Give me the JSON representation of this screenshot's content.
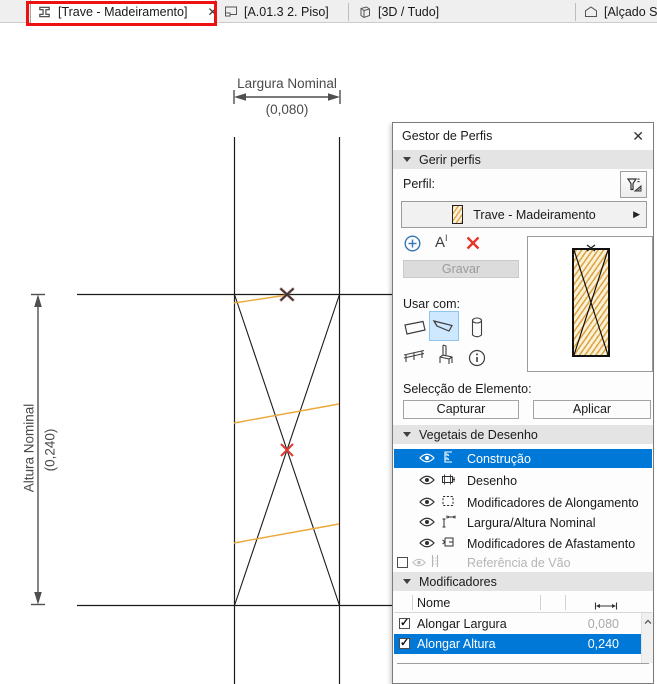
{
  "tabs": [
    {
      "label": "[Trave - Madeiramento]",
      "close": "✕"
    },
    {
      "label": "[A.01.3 2. Piso]"
    },
    {
      "label": "[3D / Tudo]"
    },
    {
      "label": "[Alçado Sul"
    }
  ],
  "drawing": {
    "width_dim": {
      "label": "Largura Nominal",
      "value": "(0,080)"
    },
    "height_dim": {
      "label": "Altura Nominal",
      "value": "(0,240)"
    }
  },
  "panel": {
    "title": "Gestor de Perfis",
    "close": "✕",
    "section_gerir": "Gerir perfis",
    "perfil_label": "Perfil:",
    "profile_name": "Trave - Madeiramento",
    "rename_a": "A",
    "rename_i": "I",
    "gravar": "Gravar",
    "usar_com": "Usar com:",
    "seleccao": "Selecção de Elemento:",
    "capturar": "Capturar",
    "aplicar": "Aplicar",
    "section_vegetais": "Vegetais de Desenho",
    "layers": [
      {
        "label": "Construção"
      },
      {
        "label": "Desenho"
      },
      {
        "label": "Modificadores de Alongamento"
      },
      {
        "label": "Largura/Altura Nominal"
      },
      {
        "label": "Modificadores de Afastamento"
      },
      {
        "label": "Referência de Vão"
      }
    ],
    "section_modificadores": "Modificadores",
    "table": {
      "name_header": "Nome",
      "rows": [
        {
          "name": "Alongar Largura",
          "value": "0,080"
        },
        {
          "name": "Alongar Altura",
          "value": "0,240"
        }
      ]
    }
  },
  "colors": {
    "selection_blue": "#0078d7",
    "annotation_red": "#ee1111",
    "modifier_orange": "#eca93c",
    "marker_red": "#e03a30",
    "hatch_orange": "#dda848"
  }
}
